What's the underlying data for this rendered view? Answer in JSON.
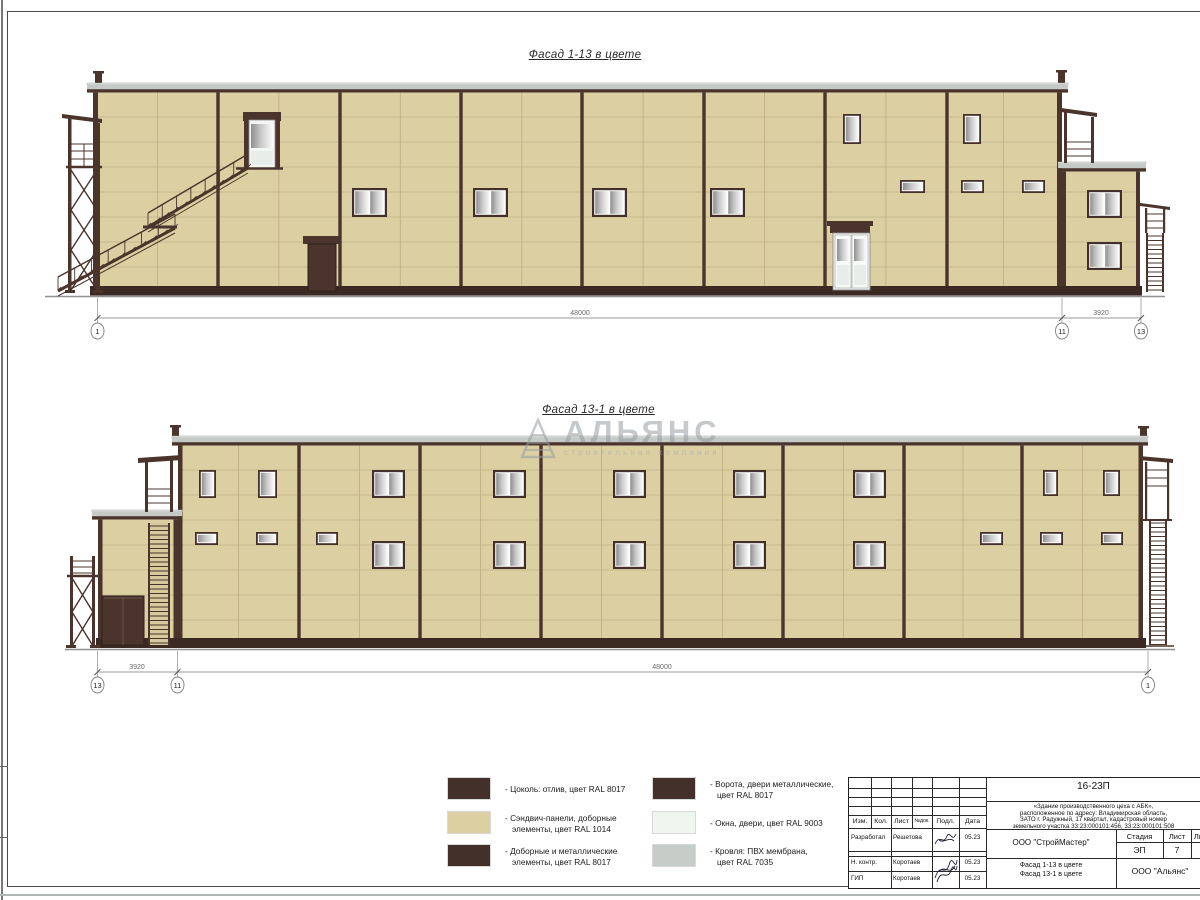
{
  "sheet": {
    "facades": [
      {
        "title": "Фасад 1-13 в цвете",
        "dim_main": "48000",
        "dim_side": "3920",
        "axis_left": "1",
        "axis_mid": "11",
        "axis_right": "13"
      },
      {
        "title": "Фасад 13-1 в цвете",
        "dim_main": "48000",
        "dim_side": "3920",
        "axis_left": "13",
        "axis_mid": "11",
        "axis_right": "1"
      }
    ]
  },
  "legend": {
    "columns": [
      {
        "items": [
          {
            "name": "plinth-swatch",
            "color": "#44302B",
            "lines": [
              "- Цоколь: отлив, цвет RAL 8017"
            ]
          },
          {
            "name": "sandwich-panel-swatch",
            "color": "#DCD0A2",
            "lines": [
              "- Сэндвич-панели, доборные",
              "элементы, цвет RAL 1014"
            ]
          },
          {
            "name": "trim-metal-swatch",
            "color": "#44302B",
            "lines": [
              "- Доборные и металлические",
              "элементы, цвет RAL 8017"
            ]
          }
        ]
      },
      {
        "items": [
          {
            "name": "gates-doors-swatch",
            "color": "#44302B",
            "lines": [
              "- Ворота, двери металлические,",
              "цвет RAL 8017"
            ]
          },
          {
            "name": "windows-doors-swatch",
            "color": "#EFF5EF",
            "lines": [
              "- Окна, двери, цвет RAL 9003"
            ]
          },
          {
            "name": "roof-membrane-swatch",
            "color": "#C6CCC7",
            "lines": [
              "- Кровля: ПВХ мембрана,",
              "цвет RAL 7035"
            ]
          }
        ]
      }
    ]
  },
  "title_block": {
    "doc_number": "16-23П",
    "description_lines": [
      "«Здание производственного цеха с АБК»,",
      "расположенное по адресу: Владимирская область,",
      "ЗАТО г. Радужный, 17 квартал, кадастровый номер",
      "земельного участка 33:23:000101:456, 33:23:000101:508"
    ],
    "header_cols": [
      "Изм.",
      "Кол.",
      "Лист",
      "№док.",
      "Подл.",
      "Дата"
    ],
    "rows": [
      {
        "role": "Разработал",
        "name": "Решетова",
        "date": "05.23"
      },
      {
        "role": "Н. контр.",
        "name": "Коротаев",
        "date": "05.23"
      },
      {
        "role": "ГИП",
        "name": "Коротаев",
        "date": "05.23"
      }
    ],
    "company": "ООО \"СтройМастер\"",
    "stage_label": "Стадия",
    "sheet_label": "Лист",
    "sheets_label": "Листов",
    "stage": "ЭП",
    "sheet_num": "7",
    "sheets_total": "1",
    "subject_lines": [
      "Фасад 1-13 в цвете",
      "Фасад 13-1 в цвете"
    ],
    "org": "ООО \"Альянс\""
  },
  "watermark": {
    "text": "АЛЬЯНС",
    "subtext": "строительная компания"
  },
  "colors": {
    "wall": "#DCD0A2",
    "panel_line": "#BFB186",
    "joint": "#4A342C",
    "plinth": "#3B2A23",
    "dark": "#44302B",
    "roof_gray": "#C6CAC7",
    "roof_light": "#E6E9E6",
    "window_white": "#EFF5EF",
    "ground": "#909090",
    "dim": "#9A9A9A",
    "frame": "#3A3A3A"
  }
}
